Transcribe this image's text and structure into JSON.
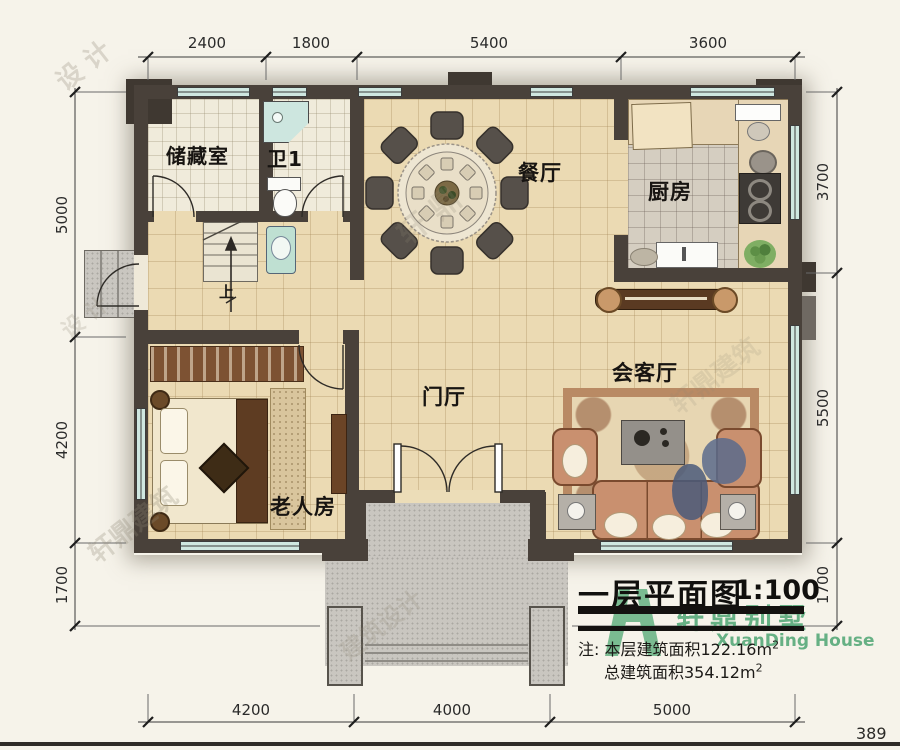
{
  "page": {
    "number": "389"
  },
  "title_block": {
    "title": "一层平面图",
    "scale": "1:100",
    "note_prefix": "注:",
    "note1": "本层建筑面积122.16m",
    "note1_sup": "2",
    "note2": "总建筑面积354.12m",
    "note2_sup": "2"
  },
  "logo": {
    "name_cn": "轩鼎别墅",
    "name_en": "XuanDing House",
    "color": "#3e9e68"
  },
  "rooms": {
    "storage": {
      "label": "储藏室"
    },
    "bath": {
      "label": "卫1"
    },
    "dining": {
      "label": "餐厅"
    },
    "kitchen": {
      "label": "厨房"
    },
    "hall": {
      "label": "门厅"
    },
    "living": {
      "label": "会客厅"
    },
    "bedroom": {
      "label": "老人房"
    }
  },
  "stairs": {
    "up_label": "上"
  },
  "dimensions": {
    "top": [
      "2400",
      "1800",
      "5400",
      "3600"
    ],
    "bottom": [
      "4200",
      "4000",
      "5000"
    ],
    "left": [
      "5000",
      "4200",
      "1700"
    ],
    "right": [
      "3700",
      "5500",
      "1700"
    ]
  },
  "watermarks": [
    "设 计",
    "轩 鼎",
    "轩鼎建筑",
    "建筑设计",
    "轩鼎建筑",
    "设 计"
  ],
  "colors": {
    "wall": "#49413a",
    "window_glass": "#cfe7e0",
    "floor_tile": "#ebdab3",
    "porch": "#c9c6c0",
    "accent_green": "#3e9e68"
  }
}
